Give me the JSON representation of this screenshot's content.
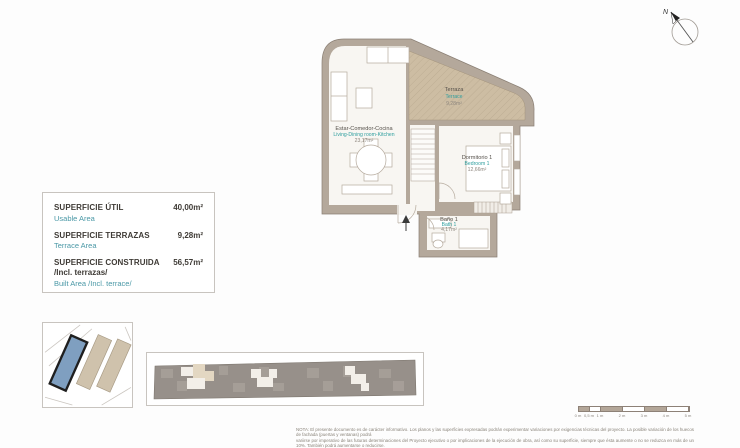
{
  "compass": {
    "label": "N"
  },
  "area_table": {
    "rows": [
      {
        "label_es": "SUPERFICIE ÚTIL",
        "label_en": "Usable Area",
        "value": "40,00m²"
      },
      {
        "label_es": "SUPERFICIE TERRAZAS",
        "label_en": "Terrace Area",
        "value": "9,28m²"
      },
      {
        "label_es": "SUPERFICIE CONSTRUIDA",
        "label_es_2": "/Incl. terrazas/",
        "label_en": "Built Area /Incl. terrace/",
        "value": "56,57m²"
      }
    ]
  },
  "floor_plan": {
    "rooms": [
      {
        "name_es": "Terraza",
        "name_en": "Terrace",
        "area": "9,28m²"
      },
      {
        "name_es": "Estar-Comedor-Cocina",
        "name_en": "Living-Dining room-Kitchen",
        "area": "23,17m²"
      },
      {
        "name_es": "Dormitorio 1",
        "name_en": "Bedroom 1",
        "area": "12,66m²"
      },
      {
        "name_es": "Baño 1",
        "name_en": "Bath 1",
        "area": "4,17m²"
      }
    ]
  },
  "scale_bar": {
    "labels": [
      "0 m",
      "0,5 m",
      "1 m",
      "2 m",
      "3 m",
      "4 m",
      "5 m"
    ]
  },
  "disclaimer": {
    "line1": "NOTA: El presente documento es de carácter informativo. Los planos y las superficies expresadas podrán experimentar variaciones por exigencias técnicas del proyecto. La posible variación de los huecos de fachada (puertas y ventanas) podrá",
    "line2": "variirse por imperativo de las futuras determinaciones del Proyecto ejecutivo o por implicaciones de la ejecución de obra, así como su superficie, siempre que ésta aumente o no se reduzca en más de un 10%. También podrá aumentarse o reducirse."
  },
  "colors": {
    "wall": "#b4a89b",
    "terrace_fill": "#cdbda3",
    "floor": "#f8f6f2",
    "accent_teal": "#2d9e9e",
    "site_highlight_blue": "#7f9fc0",
    "site_building_tan": "#cfc2ac",
    "text_dark": "#3f3b36"
  }
}
